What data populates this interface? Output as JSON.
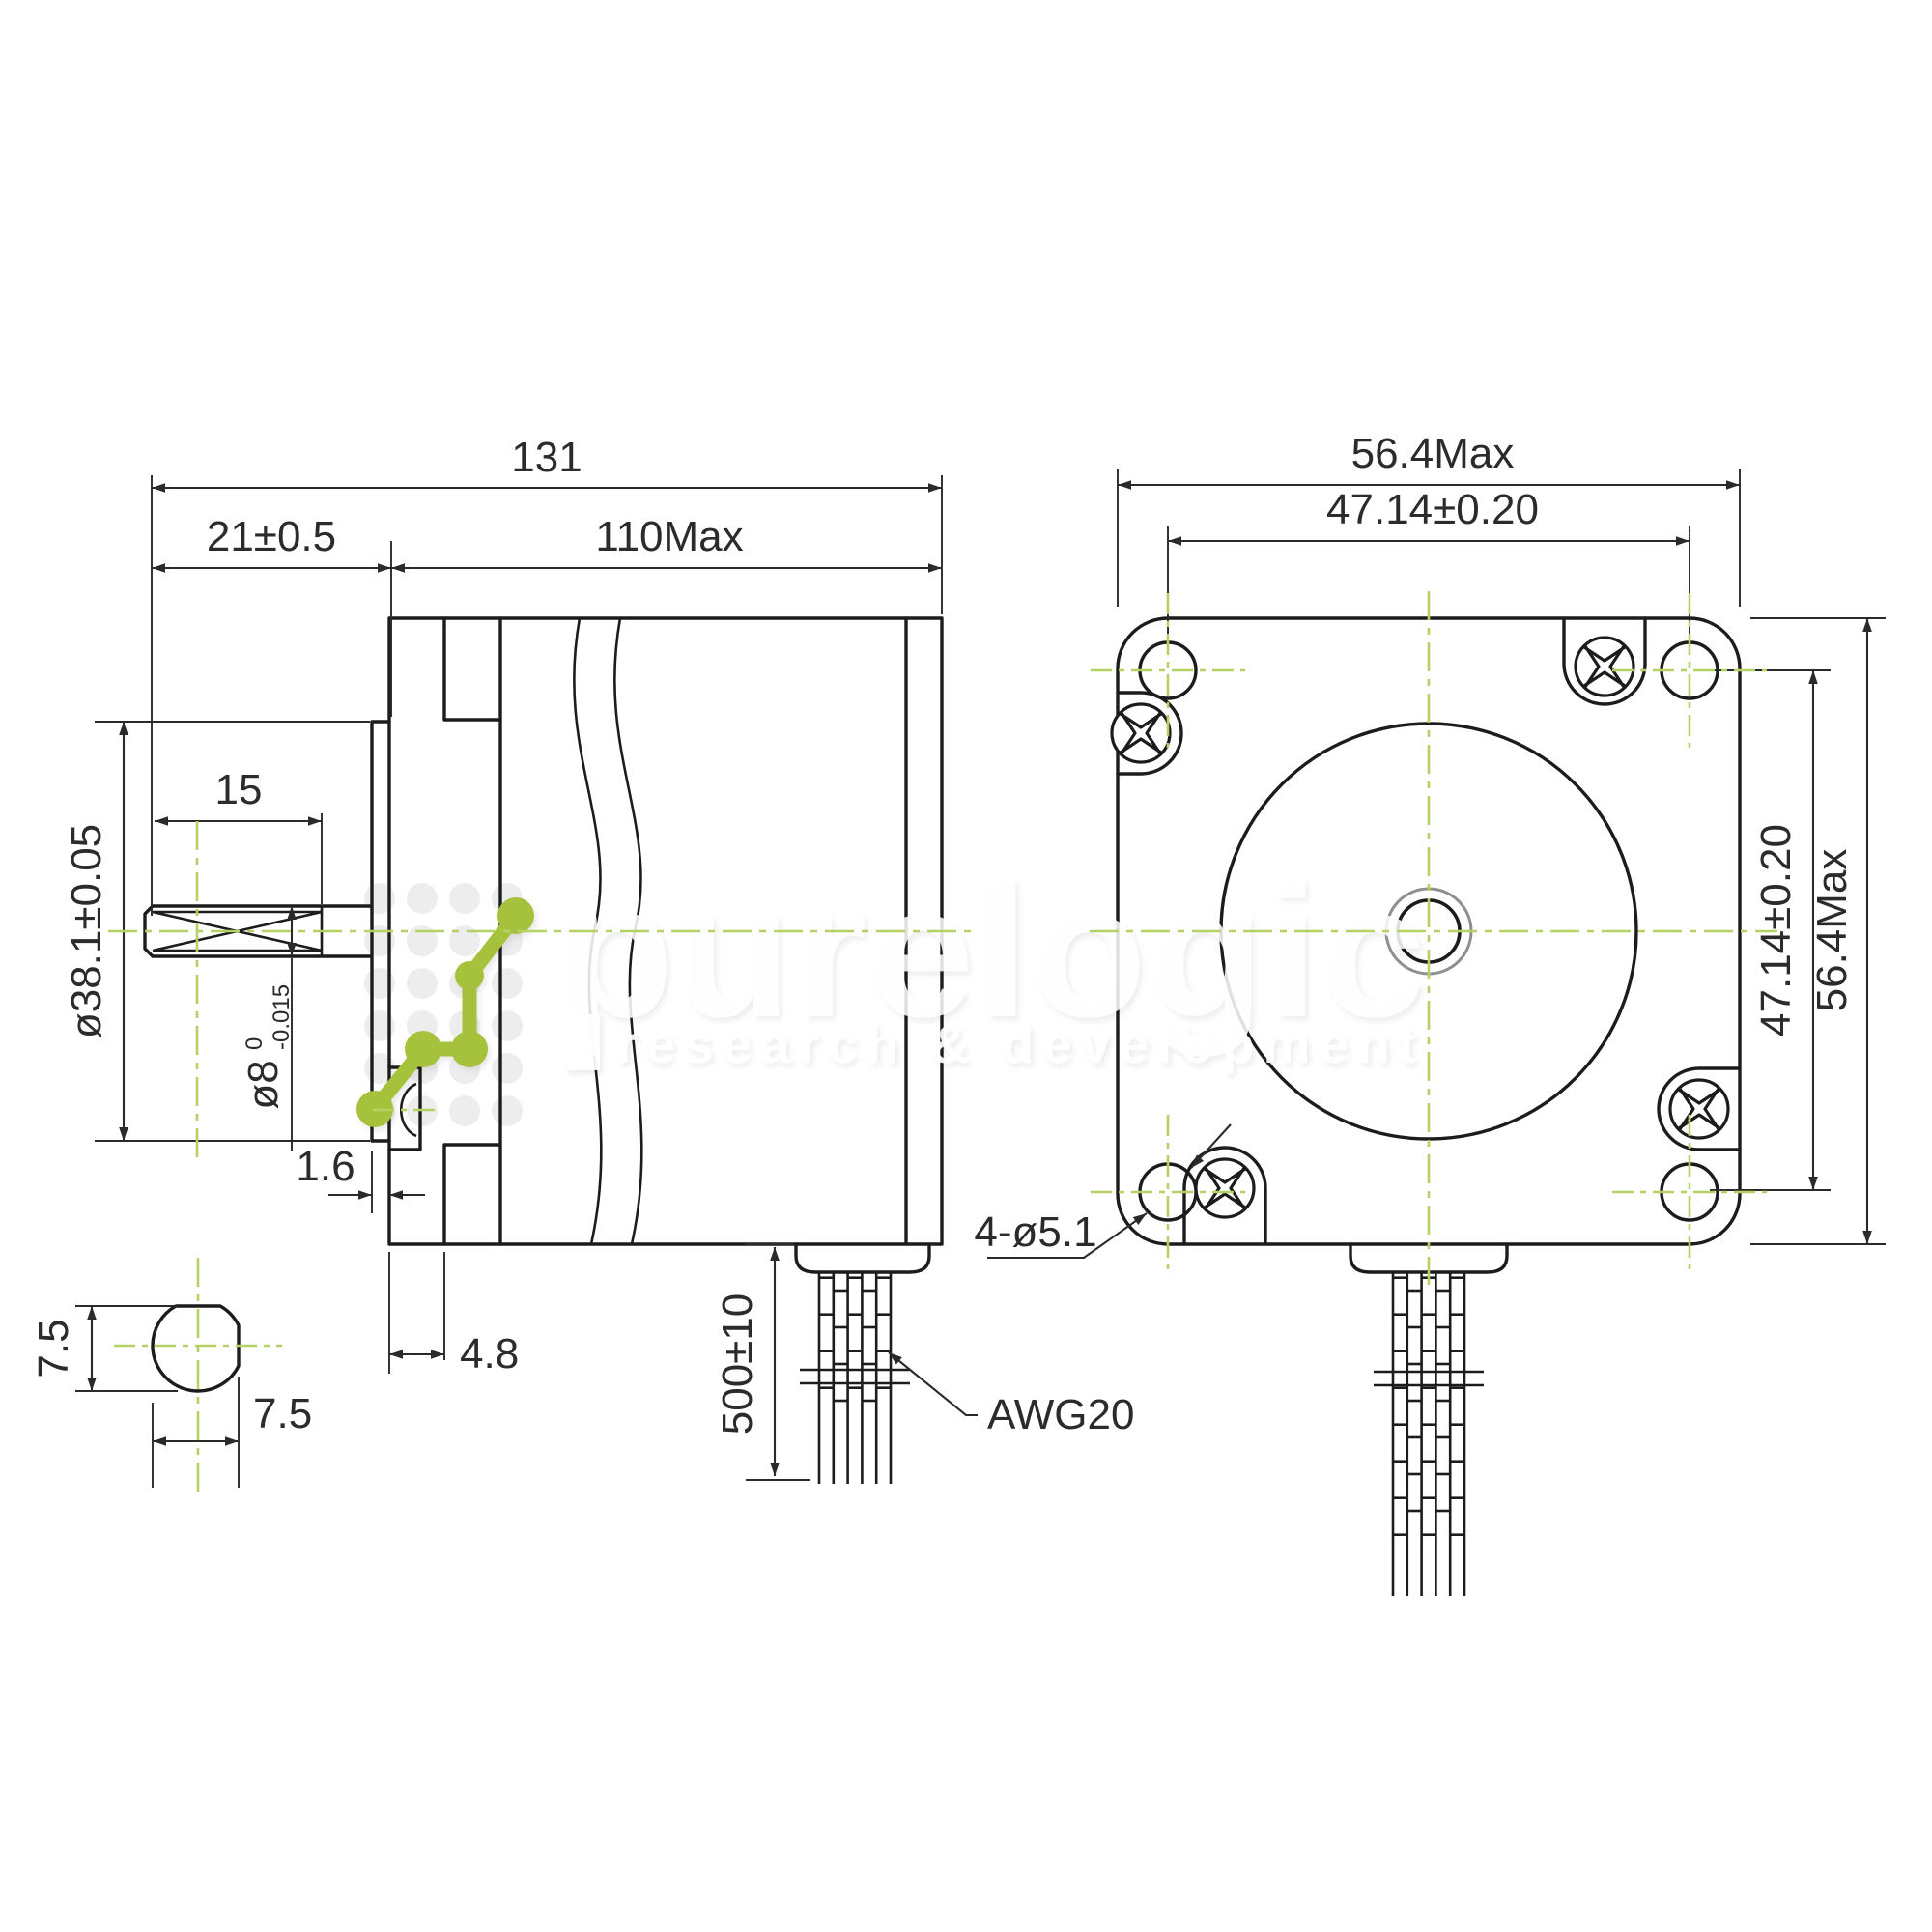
{
  "watermark": {
    "brand": "purelogic",
    "tagline": "research & development",
    "logo_green": "#a6c23e",
    "centerline_green": "#b4d264"
  },
  "line_color": "#1c1c1c",
  "side_view": {
    "total_length": "131",
    "shaft_extension": "21±0.5",
    "body_length": "110Max",
    "shaft_flat_length": "15",
    "pilot_diameter": "ø38.1±0.05",
    "shaft_diameter": "ø8",
    "shaft_tol_upper": "0",
    "shaft_tol_lower": "-0.015",
    "pilot_depth": "1.6",
    "front_step": "4.8",
    "lead_length": "500±10",
    "wire_gauge": "AWG20"
  },
  "front_view": {
    "width": "56.4Max",
    "hole_pitch_horizontal": "47.14±0.20",
    "hole_pitch_vertical": "47.14±0.20",
    "height": "56.4Max",
    "mounting_holes": "4-ø5.1"
  },
  "shaft_section": {
    "across_flats_vertical": "7.5",
    "across_flats_horizontal": "7.5"
  }
}
